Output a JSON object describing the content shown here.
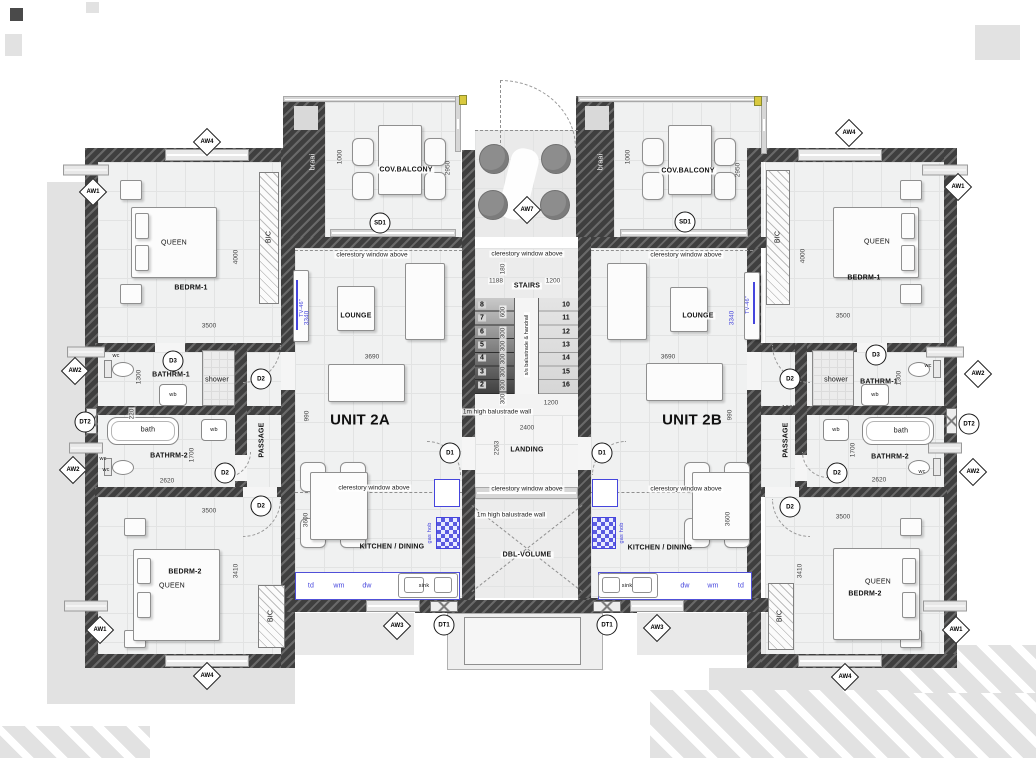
{
  "plan": {
    "units": [
      {
        "label": "UNIT 2A"
      },
      {
        "label": "UNIT 2B"
      }
    ],
    "rooms": {
      "bedrm1": "BEDRM-1",
      "bedrm2": "BEDRM-2",
      "bathrm1": "BATHRM-1",
      "bathrm2": "BATHRM-2",
      "lounge": "LOUNGE",
      "kitchen": "KITCHEN / DINING",
      "balcony": "COV.BALCONY",
      "passage": "PASSAGE",
      "stairs": "STAIRS",
      "landing": "LANDING",
      "dblvolume": "DBL-VOLUME"
    },
    "annotations": {
      "clerestory": "clerestory window above",
      "balustrade_wall": "1m high balustrade wall",
      "handrail": "s/s balustrade & handrail",
      "braai": "braai",
      "queen": "QUEEN",
      "tv": "TV-46\"",
      "bic": "BIC"
    },
    "fixtures": {
      "wc": "wc",
      "wb": "wb",
      "bath": "bath",
      "shower": "shower",
      "sink": "sink",
      "td": "td",
      "wm": "wm",
      "dw": "dw",
      "gashob": "gas hob"
    },
    "markers": {
      "aw1": "AW1",
      "aw2": "AW2",
      "aw3": "AW3",
      "aw4": "AW4",
      "aw7": "AW7",
      "d1": "D1",
      "d2": "D2",
      "d3": "D3",
      "dt1": "DT1",
      "dt2": "DT2",
      "sd1": "SD1"
    },
    "stairs": {
      "left_flight": [
        "8",
        "7",
        "6",
        "5",
        "4",
        "3",
        "2"
      ],
      "right_flight": [
        "10",
        "11",
        "12",
        "13",
        "14",
        "15",
        "16"
      ]
    },
    "dims": {
      "d180": "180",
      "d220": "220",
      "d300": "300",
      "d600": "600",
      "d990": "990",
      "d1000": "1000",
      "d1188": "1188",
      "d1200": "1200",
      "d1300": "1300",
      "d1700": "1700",
      "d2263": "2263",
      "d2400": "2400",
      "d2620": "2620",
      "d2950": "2950",
      "d3340": "3340",
      "d3410": "3410",
      "d3500": "3500",
      "d3600": "3600",
      "d3690": "3690",
      "d4000": "4000"
    },
    "colors": {
      "wall": "#3f3f3f",
      "accent_blue": "#4545dd",
      "floor": "#f0f1f1",
      "shadow": "#e2e2e2",
      "marker_yellow": "#d9c93f"
    }
  }
}
